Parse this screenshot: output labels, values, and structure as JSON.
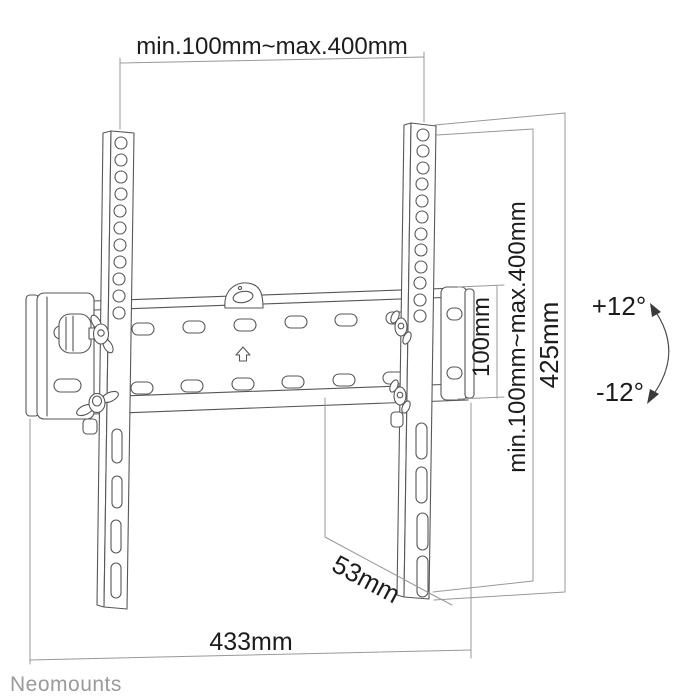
{
  "background": "#ffffff",
  "brand": {
    "logo_text": "Neomounts",
    "logo_color": "#9a9a9a"
  },
  "drawing": {
    "subject": "tilting flat-screen wall-mount bracket, dimensional line drawing",
    "line_color": "#575757",
    "dimension_line_color": "#989898",
    "label_color": "#1c1c1c"
  },
  "labels": {
    "mount_width_range": "min.100mm~max.400mm",
    "plate_height": "100mm",
    "mount_height_range": "min.100mm~max.400mm",
    "bracket_height": "425mm",
    "tilt_up": "+12°",
    "tilt_down": "-12°",
    "wall_distance": "53mm",
    "plate_width": "433mm"
  }
}
